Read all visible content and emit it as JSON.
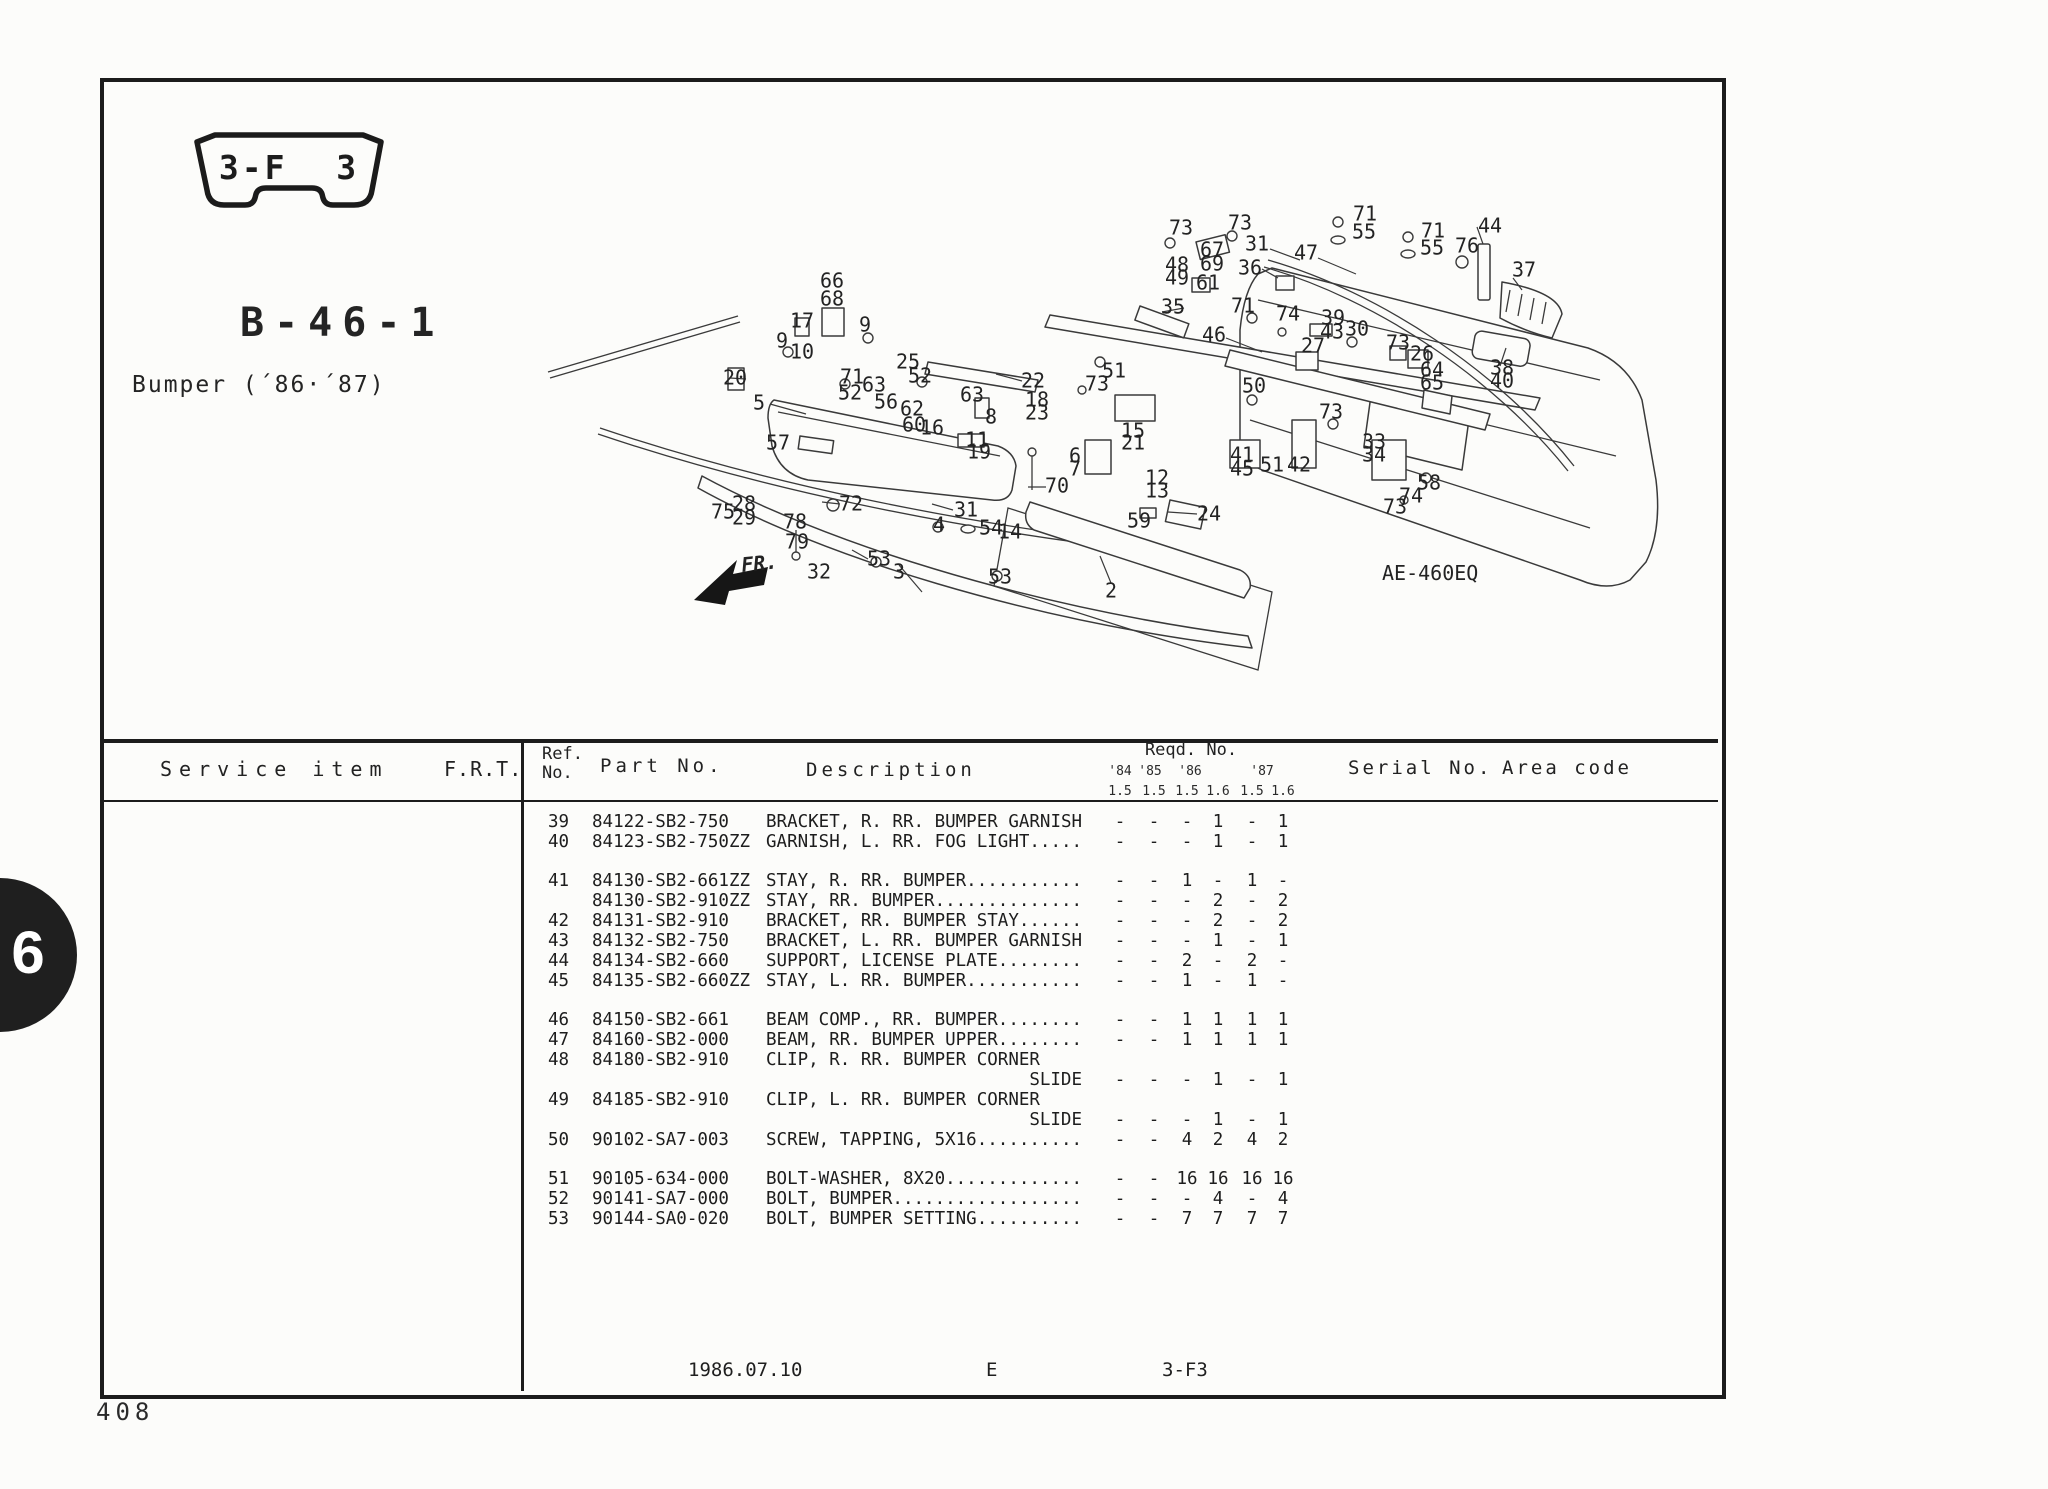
{
  "page": {
    "badge": "3-F 3",
    "section_code": "B-46-1",
    "subtitle": "Bumper (´86·´87)",
    "tab_number": "6",
    "page_number": "408",
    "footer": {
      "date": "1986.07.10",
      "edition": "E",
      "section": "3-F3"
    }
  },
  "diagram": {
    "ref_label": "AE-460EQ",
    "fr_label": "FR.",
    "callouts": [
      {
        "n": "66",
        "x": 832,
        "y": 282
      },
      {
        "n": "68",
        "x": 832,
        "y": 300
      },
      {
        "n": "17",
        "x": 802,
        "y": 322
      },
      {
        "n": "9",
        "x": 782,
        "y": 342
      },
      {
        "n": "10",
        "x": 802,
        "y": 353
      },
      {
        "n": "9",
        "x": 865,
        "y": 326
      },
      {
        "n": "20",
        "x": 735,
        "y": 379
      },
      {
        "n": "5",
        "x": 759,
        "y": 404
      },
      {
        "n": "71",
        "x": 852,
        "y": 378
      },
      {
        "n": "52",
        "x": 850,
        "y": 394
      },
      {
        "n": "63",
        "x": 874,
        "y": 386
      },
      {
        "n": "25",
        "x": 908,
        "y": 363
      },
      {
        "n": "52",
        "x": 920,
        "y": 377
      },
      {
        "n": "63",
        "x": 972,
        "y": 396
      },
      {
        "n": "56",
        "x": 886,
        "y": 403
      },
      {
        "n": "62",
        "x": 912,
        "y": 410
      },
      {
        "n": "60",
        "x": 914,
        "y": 426
      },
      {
        "n": "16",
        "x": 932,
        "y": 429
      },
      {
        "n": "22",
        "x": 1033,
        "y": 382
      },
      {
        "n": "18",
        "x": 1037,
        "y": 401
      },
      {
        "n": "23",
        "x": 1037,
        "y": 414
      },
      {
        "n": "8",
        "x": 991,
        "y": 418
      },
      {
        "n": "11",
        "x": 977,
        "y": 441
      },
      {
        "n": "19",
        "x": 979,
        "y": 453
      },
      {
        "n": "57",
        "x": 778,
        "y": 444
      },
      {
        "n": "75",
        "x": 723,
        "y": 513
      },
      {
        "n": "28",
        "x": 744,
        "y": 505
      },
      {
        "n": "29",
        "x": 744,
        "y": 519
      },
      {
        "n": "78",
        "x": 795,
        "y": 523
      },
      {
        "n": "79",
        "x": 797,
        "y": 543
      },
      {
        "n": "32",
        "x": 819,
        "y": 573
      },
      {
        "n": "72",
        "x": 851,
        "y": 505
      },
      {
        "n": "31",
        "x": 966,
        "y": 511
      },
      {
        "n": "4",
        "x": 939,
        "y": 526
      },
      {
        "n": "54",
        "x": 991,
        "y": 529
      },
      {
        "n": "14",
        "x": 1010,
        "y": 533
      },
      {
        "n": "53",
        "x": 879,
        "y": 560
      },
      {
        "n": "3",
        "x": 899,
        "y": 573
      },
      {
        "n": "53",
        "x": 1000,
        "y": 578
      },
      {
        "n": "70",
        "x": 1057,
        "y": 487
      },
      {
        "n": "2",
        "x": 1111,
        "y": 592
      },
      {
        "n": "59",
        "x": 1139,
        "y": 522
      },
      {
        "n": "24",
        "x": 1209,
        "y": 515
      },
      {
        "n": "12",
        "x": 1157,
        "y": 479
      },
      {
        "n": "13",
        "x": 1157,
        "y": 492
      },
      {
        "n": "6",
        "x": 1075,
        "y": 457
      },
      {
        "n": "7",
        "x": 1075,
        "y": 470
      },
      {
        "n": "15",
        "x": 1133,
        "y": 432
      },
      {
        "n": "21",
        "x": 1133,
        "y": 444
      },
      {
        "n": "41",
        "x": 1242,
        "y": 456
      },
      {
        "n": "45",
        "x": 1242,
        "y": 470
      },
      {
        "n": "51",
        "x": 1272,
        "y": 466
      },
      {
        "n": "42",
        "x": 1299,
        "y": 466
      },
      {
        "n": "73",
        "x": 1331,
        "y": 413
      },
      {
        "n": "33",
        "x": 1374,
        "y": 443
      },
      {
        "n": "34",
        "x": 1374,
        "y": 456
      },
      {
        "n": "58",
        "x": 1429,
        "y": 484
      },
      {
        "n": "74",
        "x": 1411,
        "y": 497
      },
      {
        "n": "73",
        "x": 1395,
        "y": 508
      },
      {
        "n": "51",
        "x": 1114,
        "y": 372
      },
      {
        "n": "73",
        "x": 1097,
        "y": 385
      },
      {
        "n": "73",
        "x": 1181,
        "y": 229
      },
      {
        "n": "73",
        "x": 1240,
        "y": 224
      },
      {
        "n": "31",
        "x": 1257,
        "y": 245
      },
      {
        "n": "67",
        "x": 1212,
        "y": 251
      },
      {
        "n": "48",
        "x": 1177,
        "y": 266
      },
      {
        "n": "49",
        "x": 1177,
        "y": 279
      },
      {
        "n": "69",
        "x": 1212,
        "y": 265
      },
      {
        "n": "61",
        "x": 1208,
        "y": 284
      },
      {
        "n": "36",
        "x": 1250,
        "y": 269
      },
      {
        "n": "47",
        "x": 1306,
        "y": 254
      },
      {
        "n": "71",
        "x": 1365,
        "y": 215
      },
      {
        "n": "55",
        "x": 1364,
        "y": 233
      },
      {
        "n": "71",
        "x": 1433,
        "y": 232
      },
      {
        "n": "55",
        "x": 1432,
        "y": 249
      },
      {
        "n": "44",
        "x": 1490,
        "y": 227
      },
      {
        "n": "76",
        "x": 1467,
        "y": 247
      },
      {
        "n": "37",
        "x": 1524,
        "y": 271
      },
      {
        "n": "35",
        "x": 1173,
        "y": 308
      },
      {
        "n": "71",
        "x": 1243,
        "y": 307
      },
      {
        "n": "74",
        "x": 1288,
        "y": 315
      },
      {
        "n": "39",
        "x": 1333,
        "y": 319
      },
      {
        "n": "43",
        "x": 1332,
        "y": 333
      },
      {
        "n": "30",
        "x": 1357,
        "y": 330
      },
      {
        "n": "46",
        "x": 1214,
        "y": 336
      },
      {
        "n": "27",
        "x": 1313,
        "y": 347
      },
      {
        "n": "73",
        "x": 1398,
        "y": 344
      },
      {
        "n": "26",
        "x": 1422,
        "y": 355
      },
      {
        "n": "64",
        "x": 1432,
        "y": 371
      },
      {
        "n": "65",
        "x": 1432,
        "y": 384
      },
      {
        "n": "38",
        "x": 1502,
        "y": 369
      },
      {
        "n": "40",
        "x": 1502,
        "y": 382
      },
      {
        "n": "50",
        "x": 1254,
        "y": 387
      }
    ]
  },
  "table": {
    "headers": {
      "service_item": "Service item",
      "frt": "F.R.T.",
      "ref_line1": "Ref.",
      "ref_line2": "No.",
      "part_no": "Part No.",
      "description": "Description",
      "reqd_no": "Reqd. No.",
      "serial_no": "Serial No.",
      "area_code": "Area code",
      "years": [
        {
          "label": "'84",
          "x": 1120
        },
        {
          "label": "'85",
          "x": 1150
        },
        {
          "label": "'86",
          "x": 1190
        },
        {
          "label": "'87",
          "x": 1262
        }
      ],
      "engines": [
        {
          "label": "1.5",
          "x": 1120
        },
        {
          "label": "1.5",
          "x": 1154
        },
        {
          "label": "1.5",
          "x": 1187
        },
        {
          "label": "1.6",
          "x": 1218
        },
        {
          "label": "1.5",
          "x": 1252
        },
        {
          "label": "1.6",
          "x": 1283
        }
      ]
    },
    "rows": [
      {
        "ref": "39",
        "part": "84122-SB2-750",
        "desc": "BRACKET, R. RR. BUMPER GARNISH",
        "qty": [
          "-",
          "-",
          "-",
          "1",
          "-",
          "1"
        ]
      },
      {
        "ref": "40",
        "part": "84123-SB2-750ZZ",
        "desc": "GARNISH, L. RR. FOG LIGHT.....",
        "qty": [
          "-",
          "-",
          "-",
          "1",
          "-",
          "1"
        ]
      },
      {
        "ref": "41",
        "part": "84130-SB2-661ZZ",
        "desc": "STAY, R. RR. BUMPER...........",
        "qty": [
          "-",
          "-",
          "1",
          "-",
          "1",
          "-"
        ],
        "gap": true
      },
      {
        "ref": "",
        "part": "84130-SB2-910ZZ",
        "desc": "STAY, RR. BUMPER..............",
        "qty": [
          "-",
          "-",
          "-",
          "2",
          "-",
          "2"
        ]
      },
      {
        "ref": "42",
        "part": "84131-SB2-910",
        "desc": "BRACKET, RR. BUMPER STAY......",
        "qty": [
          "-",
          "-",
          "-",
          "2",
          "-",
          "2"
        ]
      },
      {
        "ref": "43",
        "part": "84132-SB2-750",
        "desc": "BRACKET, L. RR. BUMPER GARNISH",
        "qty": [
          "-",
          "-",
          "-",
          "1",
          "-",
          "1"
        ]
      },
      {
        "ref": "44",
        "part": "84134-SB2-660",
        "desc": "SUPPORT, LICENSE PLATE........",
        "qty": [
          "-",
          "-",
          "2",
          "-",
          "2",
          "-"
        ]
      },
      {
        "ref": "45",
        "part": "84135-SB2-660ZZ",
        "desc": "STAY, L. RR. BUMPER...........",
        "qty": [
          "-",
          "-",
          "1",
          "-",
          "1",
          "-"
        ]
      },
      {
        "ref": "46",
        "part": "84150-SB2-661",
        "desc": "BEAM COMP., RR. BUMPER........",
        "qty": [
          "-",
          "-",
          "1",
          "1",
          "1",
          "1"
        ],
        "gap": true
      },
      {
        "ref": "47",
        "part": "84160-SB2-000",
        "desc": "BEAM, RR. BUMPER UPPER........",
        "qty": [
          "-",
          "-",
          "1",
          "1",
          "1",
          "1"
        ]
      },
      {
        "ref": "48",
        "part": "84180-SB2-910",
        "desc": "CLIP, R. RR. BUMPER CORNER",
        "qty": [
          "",
          "",
          "",
          "",
          "",
          ""
        ]
      },
      {
        "ref": "",
        "part": "",
        "desc": "SLIDE",
        "slide": true,
        "qty": [
          "-",
          "-",
          "-",
          "1",
          "-",
          "1"
        ]
      },
      {
        "ref": "49",
        "part": "84185-SB2-910",
        "desc": "CLIP, L. RR. BUMPER CORNER",
        "qty": [
          "",
          "",
          "",
          "",
          "",
          ""
        ]
      },
      {
        "ref": "",
        "part": "",
        "desc": "SLIDE",
        "slide": true,
        "qty": [
          "-",
          "-",
          "-",
          "1",
          "-",
          "1"
        ]
      },
      {
        "ref": "50",
        "part": "90102-SA7-003",
        "desc": "SCREW, TAPPING, 5X16..........",
        "qty": [
          "-",
          "-",
          "4",
          "2",
          "4",
          "2"
        ]
      },
      {
        "ref": "51",
        "part": "90105-634-000",
        "desc": "BOLT-WASHER, 8X20.............",
        "qty": [
          "-",
          "-",
          "16",
          "16",
          "16",
          "16"
        ],
        "gap": true
      },
      {
        "ref": "52",
        "part": "90141-SA7-000",
        "desc": "BOLT, BUMPER..................",
        "qty": [
          "-",
          "-",
          "-",
          "4",
          "-",
          "4"
        ]
      },
      {
        "ref": "53",
        "part": "90144-SA0-020",
        "desc": "BOLT, BUMPER SETTING..........",
        "qty": [
          "-",
          "-",
          "7",
          "7",
          "7",
          "7"
        ]
      }
    ]
  }
}
